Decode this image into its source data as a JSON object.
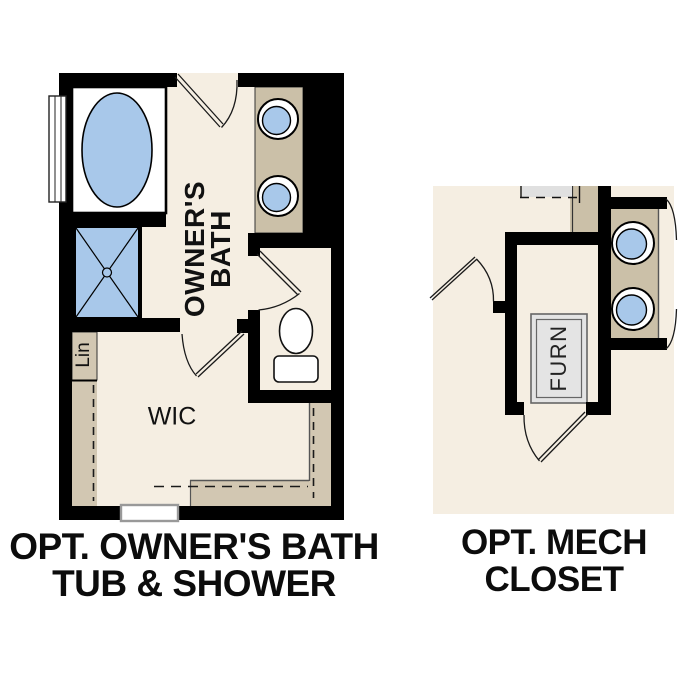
{
  "colors": {
    "wall_black": "#000000",
    "floor_cream": "#f5eee2",
    "counter_tan": "#cbc0a8",
    "closet_tan": "#d2c7b2",
    "fixture_blue": "#a8c8ea",
    "furnace_gray": "#e4e4e4",
    "overhead_gray": "#e0e0e0",
    "label_black": "#111111"
  },
  "left_plan": {
    "caption": {
      "line1": "OPT. OWNER'S BATH",
      "line2": "TUB & SHOWER"
    },
    "labels": {
      "room_line1": "OWNER'S",
      "room_line2": "BATH",
      "wic": "WIC",
      "linen": "Lin"
    }
  },
  "right_plan": {
    "caption": {
      "line1": "OPT. MECH",
      "line2": "CLOSET"
    },
    "labels": {
      "furnace": "FURN"
    }
  }
}
